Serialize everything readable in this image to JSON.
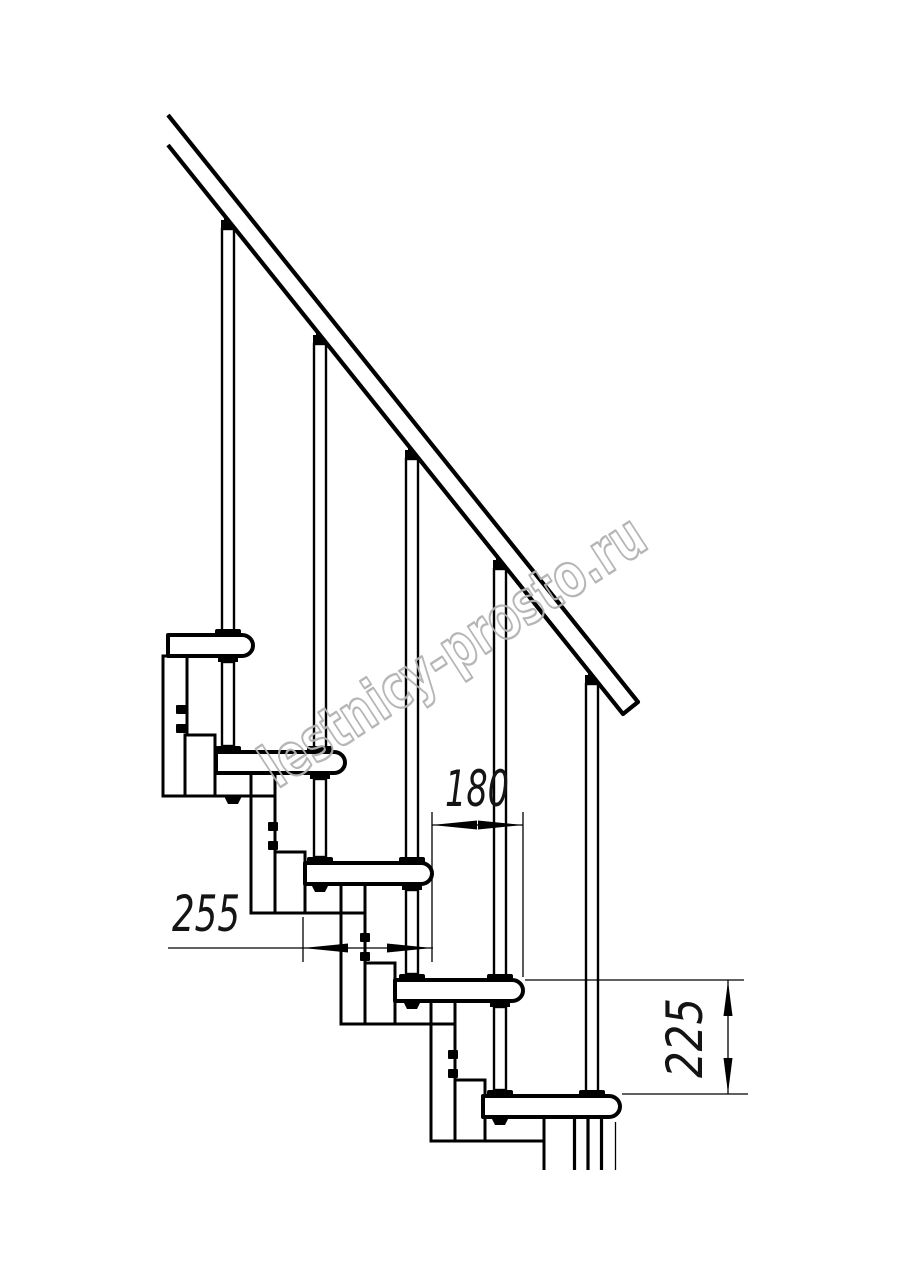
{
  "diagram": {
    "watermark_text": "lestnicy-prosto.ru",
    "dimensions": {
      "step_run": "180",
      "tread_depth": "255",
      "step_rise": "225"
    }
  },
  "colors": {
    "line": "#000000",
    "dimension_text": "#141414",
    "watermark": "#b3b3b3",
    "background": "#ffffff"
  }
}
